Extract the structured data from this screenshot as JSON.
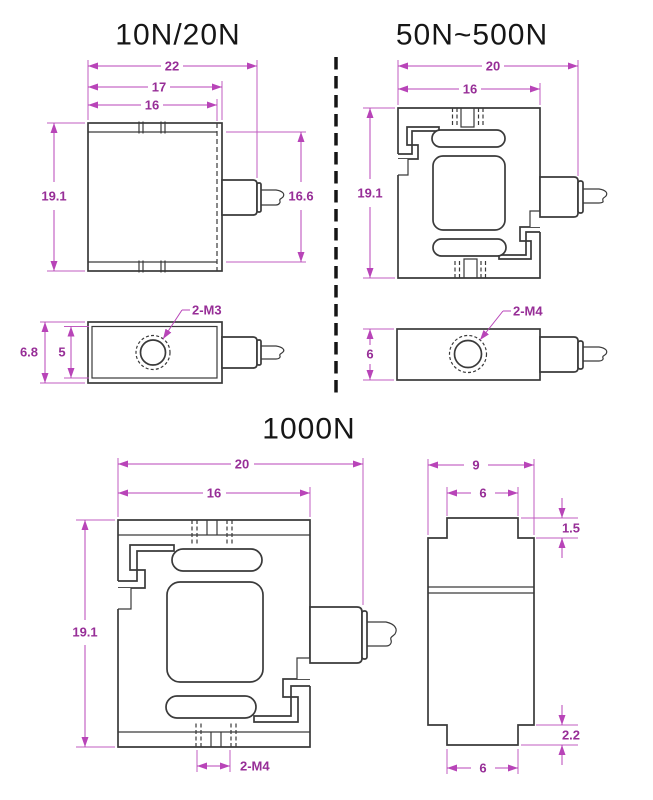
{
  "drawing": {
    "type": "load-cell-dimension-drawing",
    "units": "mm"
  },
  "models": {
    "a": {
      "title": "10N/20N",
      "front": {
        "w_outer": "22",
        "w_mid": "17",
        "w_inner": "16",
        "h_outer": "19.1",
        "h_inner": "16.6"
      },
      "side": {
        "h_outer": "6.8",
        "h_inner": "5",
        "thread": "2-M3"
      }
    },
    "b": {
      "title": "50N~500N",
      "front": {
        "w_outer": "20",
        "w_inner": "16",
        "h_outer": "19.1"
      },
      "side": {
        "h_outer": "6",
        "thread": "2-M4"
      }
    },
    "c": {
      "title": "1000N",
      "front": {
        "w_outer": "20",
        "w_inner": "16",
        "h_outer": "19.1",
        "thread": "2-M4"
      },
      "side": {
        "w_outer": "9",
        "w_top": "6",
        "t_top": "1.5",
        "t_bottom": "2.2",
        "w_bottom": "6"
      }
    }
  },
  "colors": {
    "dimension_line": "#c05cc0",
    "dimension_text": "#972e97",
    "drawing_line": "#3a3a3a",
    "title_text": "#161616",
    "background": "#ffffff"
  }
}
